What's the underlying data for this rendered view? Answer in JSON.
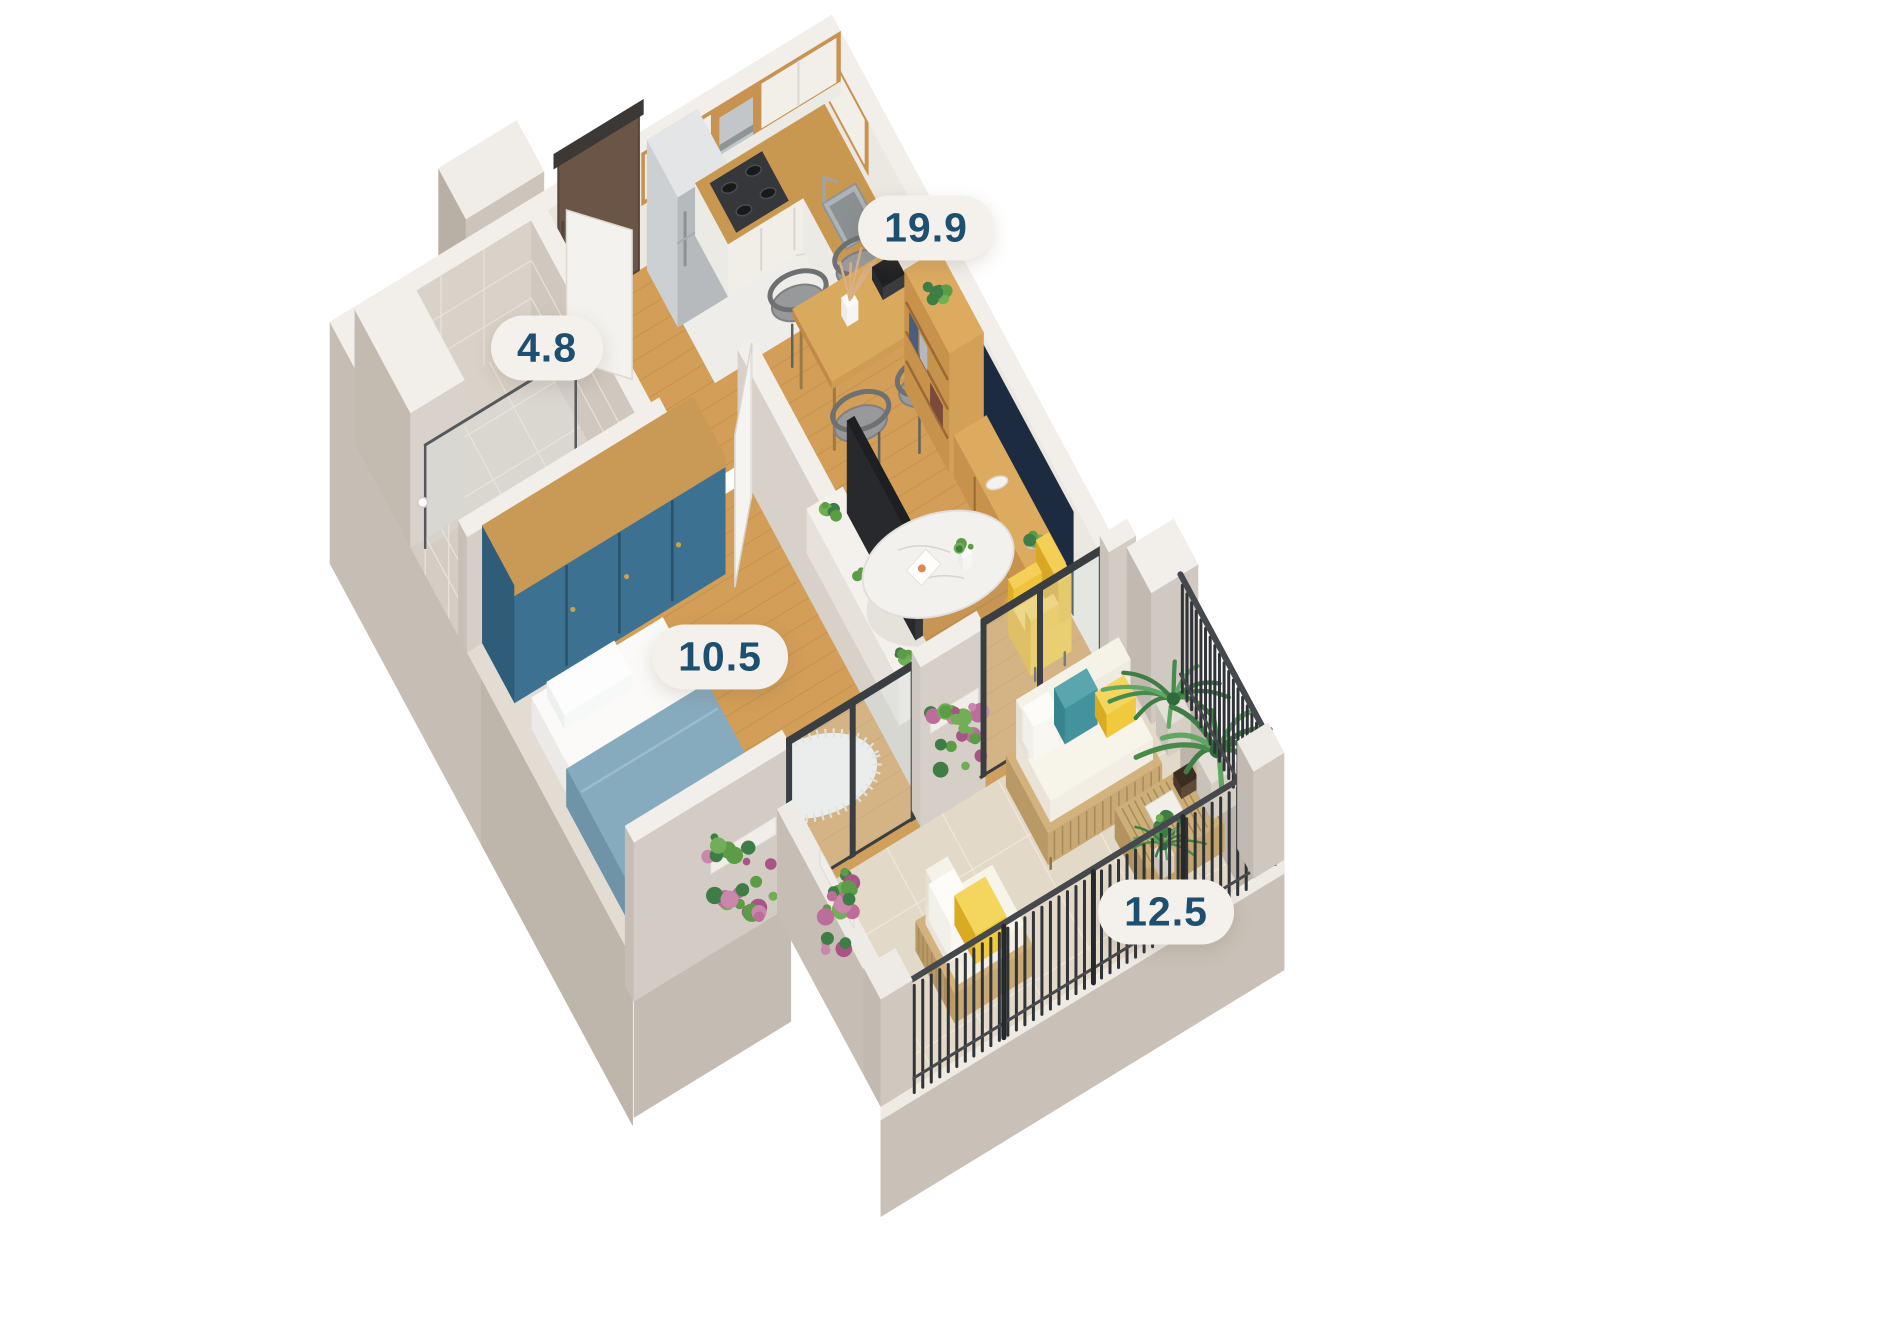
{
  "scene": {
    "kind": "3d-isometric-floor-plan-render",
    "background": "#ffffff"
  },
  "rooms": [
    {
      "id": "kitchen-living",
      "name": "kitchen and living-dining room",
      "area_label": "19.9"
    },
    {
      "id": "bathroom",
      "name": "bathroom",
      "area_label": "4.8"
    },
    {
      "id": "bedroom",
      "name": "bedroom",
      "area_label": "10.5"
    },
    {
      "id": "balcony",
      "name": "balcony terrace",
      "area_label": "12.5"
    }
  ],
  "label_style": {
    "text_color": "#1d4f70",
    "pill_color": "#f4f1ec"
  },
  "palette": {
    "wall_outer": "#c6beb4",
    "wall_outer_dk": "#b7ada2",
    "wall_top": "#f2efeb",
    "wall_inner": "#e9e4de",
    "tile": "#d9d2c8",
    "tile_grout": "#e8e1d8",
    "wood_floor": "#d39e58",
    "wood_line": "#b9863f",
    "wood_furn": "#c89351",
    "marble": "#efedea",
    "balcony_tile": "#e3d9c9",
    "balcony_grout": "#efe6d8",
    "navy_panel": "#1d2b40",
    "door_brown": "#6a5546",
    "accent_teal": "#3c7191",
    "blanket_blue": "#87abbe",
    "chair_yellow": "#f2c63c",
    "pillow_teal": "#43939e",
    "pillow_yellow": "#f0c93c",
    "railing": "#303338",
    "steel": "#c2c6c9",
    "rattan": "#c8a873",
    "gray_chair": "#97999b",
    "plant_green": "#5d9c46",
    "plant_green_dk": "#3f7d46",
    "plant_pink": "#bc6d9a",
    "glass": "#d6e2e6"
  }
}
